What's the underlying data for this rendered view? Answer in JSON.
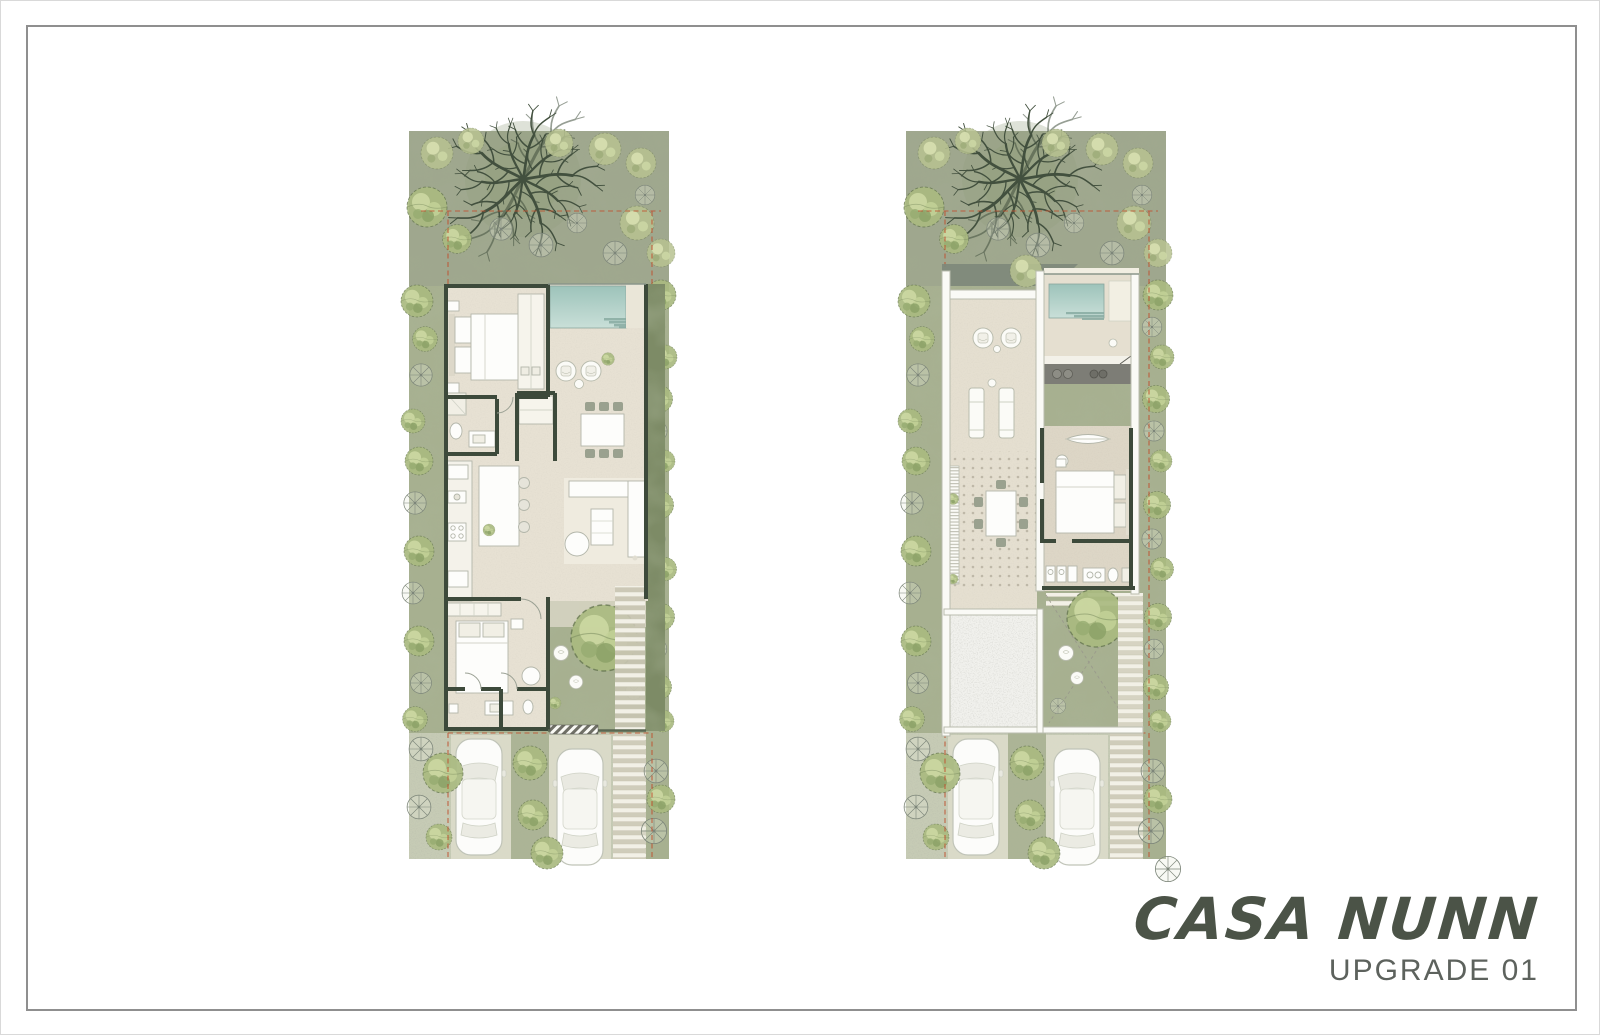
{
  "page": {
    "title": "CASA NUNN",
    "subtitle": "UPGRADE 01"
  },
  "colors": {
    "title": "#4b5347",
    "subtitle": "#5d625d",
    "site_green": "#a7b090",
    "top_garden_green": "#99a18c",
    "hedge_green": "#7d8b66",
    "tree_green": "#a9ba80",
    "wall_dark": "#3d4a3b",
    "floor_beige": "#e7e1d3",
    "pool_teal": "#a9cdc3",
    "parapet_white": "#fafaf6",
    "driveway_gravel": "#c9cdb8",
    "boundary_red": "#c0512f"
  }
}
